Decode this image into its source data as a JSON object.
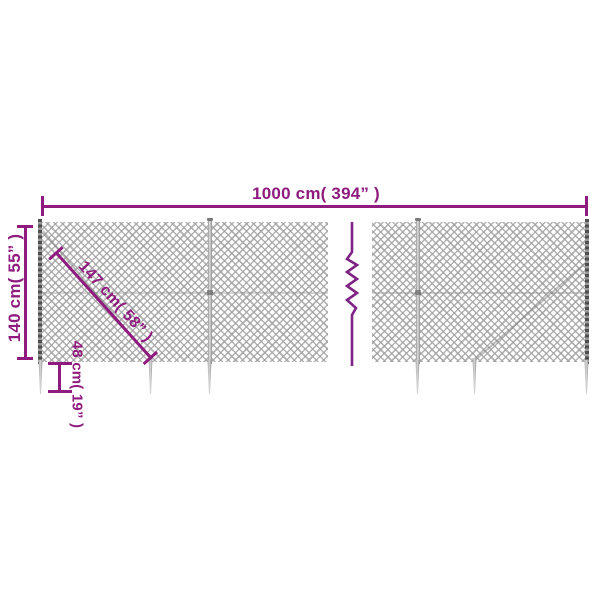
{
  "diagram": {
    "kind": "product-dimension-diagram",
    "subject": "chain-link fence with ground anchor spikes",
    "dimensions": {
      "total_width": {
        "value_cm": 1000,
        "value_inch": 394,
        "label": "1000 cm( 394” )"
      },
      "fence_height": {
        "value_cm": 140,
        "value_inch": 55,
        "label": "140 cm( 55” )"
      },
      "brace_diagonal": {
        "value_cm": 147,
        "value_inch": 58,
        "label": "147 cm( 58” )"
      },
      "anchor_spike_length": {
        "value_cm": 48,
        "value_inch": 19,
        "label": "48 cm( 19” )"
      }
    },
    "colors": {
      "dimension_accent": "#8e1b7d",
      "break_line": "#7d2383",
      "mesh_wire": "#9e9e9e",
      "post_gray": "#9a9a9a",
      "end_post_dark": "#4f4f4f",
      "background": "#ffffff"
    }
  }
}
